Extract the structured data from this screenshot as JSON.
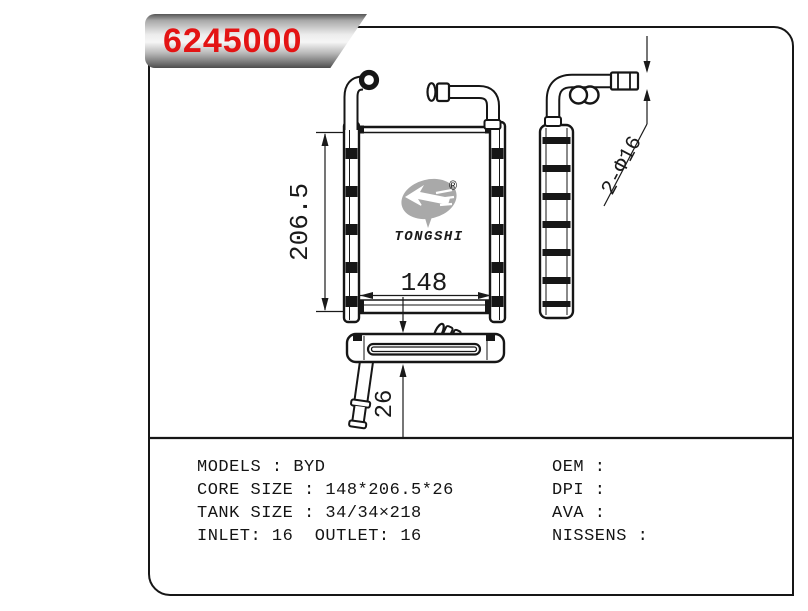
{
  "banner": {
    "part_number": "6245000",
    "text_color": "#e31414"
  },
  "logo": {
    "brand": "TONGSHI",
    "registered": "®"
  },
  "drawing": {
    "dim_height": "206.5",
    "dim_width": "148",
    "dim_depth": "26",
    "dim_pipes": "2-Φ16"
  },
  "specs": {
    "left": [
      "MODELS : BYD",
      "CORE SIZE : 148*206.5*26",
      "TANK SIZE : 34/34×218",
      "INLET: 16  OUTLET: 16"
    ],
    "right": [
      "OEM :",
      "DPI :",
      "AVA :",
      "NISSENS :"
    ]
  },
  "colors": {
    "line": "#161616",
    "watermark": "#a9a9a9",
    "accent_red": "#e31414"
  }
}
